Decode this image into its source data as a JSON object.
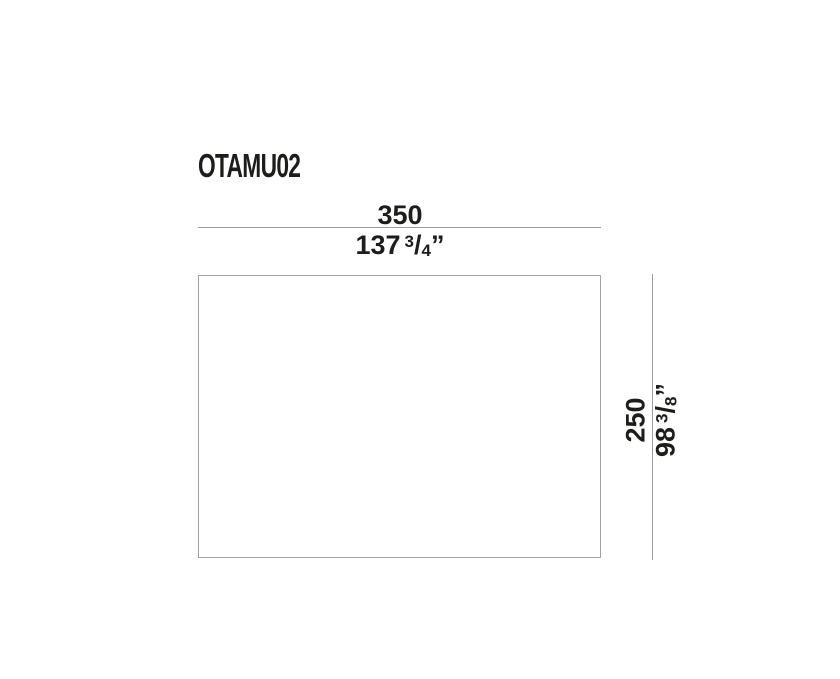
{
  "drawing": {
    "product_code": "OTAMU02",
    "width_dimension": {
      "metric_value": "350",
      "imperial": {
        "whole": "137",
        "numerator": "3",
        "slash": "/",
        "denominator": "4",
        "inch_mark": "”"
      }
    },
    "height_dimension": {
      "metric_value": "250",
      "imperial": {
        "whole": "98",
        "numerator": "3",
        "slash": "/",
        "denominator": "8",
        "inch_mark": "”"
      }
    },
    "colors": {
      "text": "#1d1d1b",
      "dimension_line": "#9d9d9c",
      "outline": "#a3a3a2",
      "background": "#ffffff"
    }
  }
}
